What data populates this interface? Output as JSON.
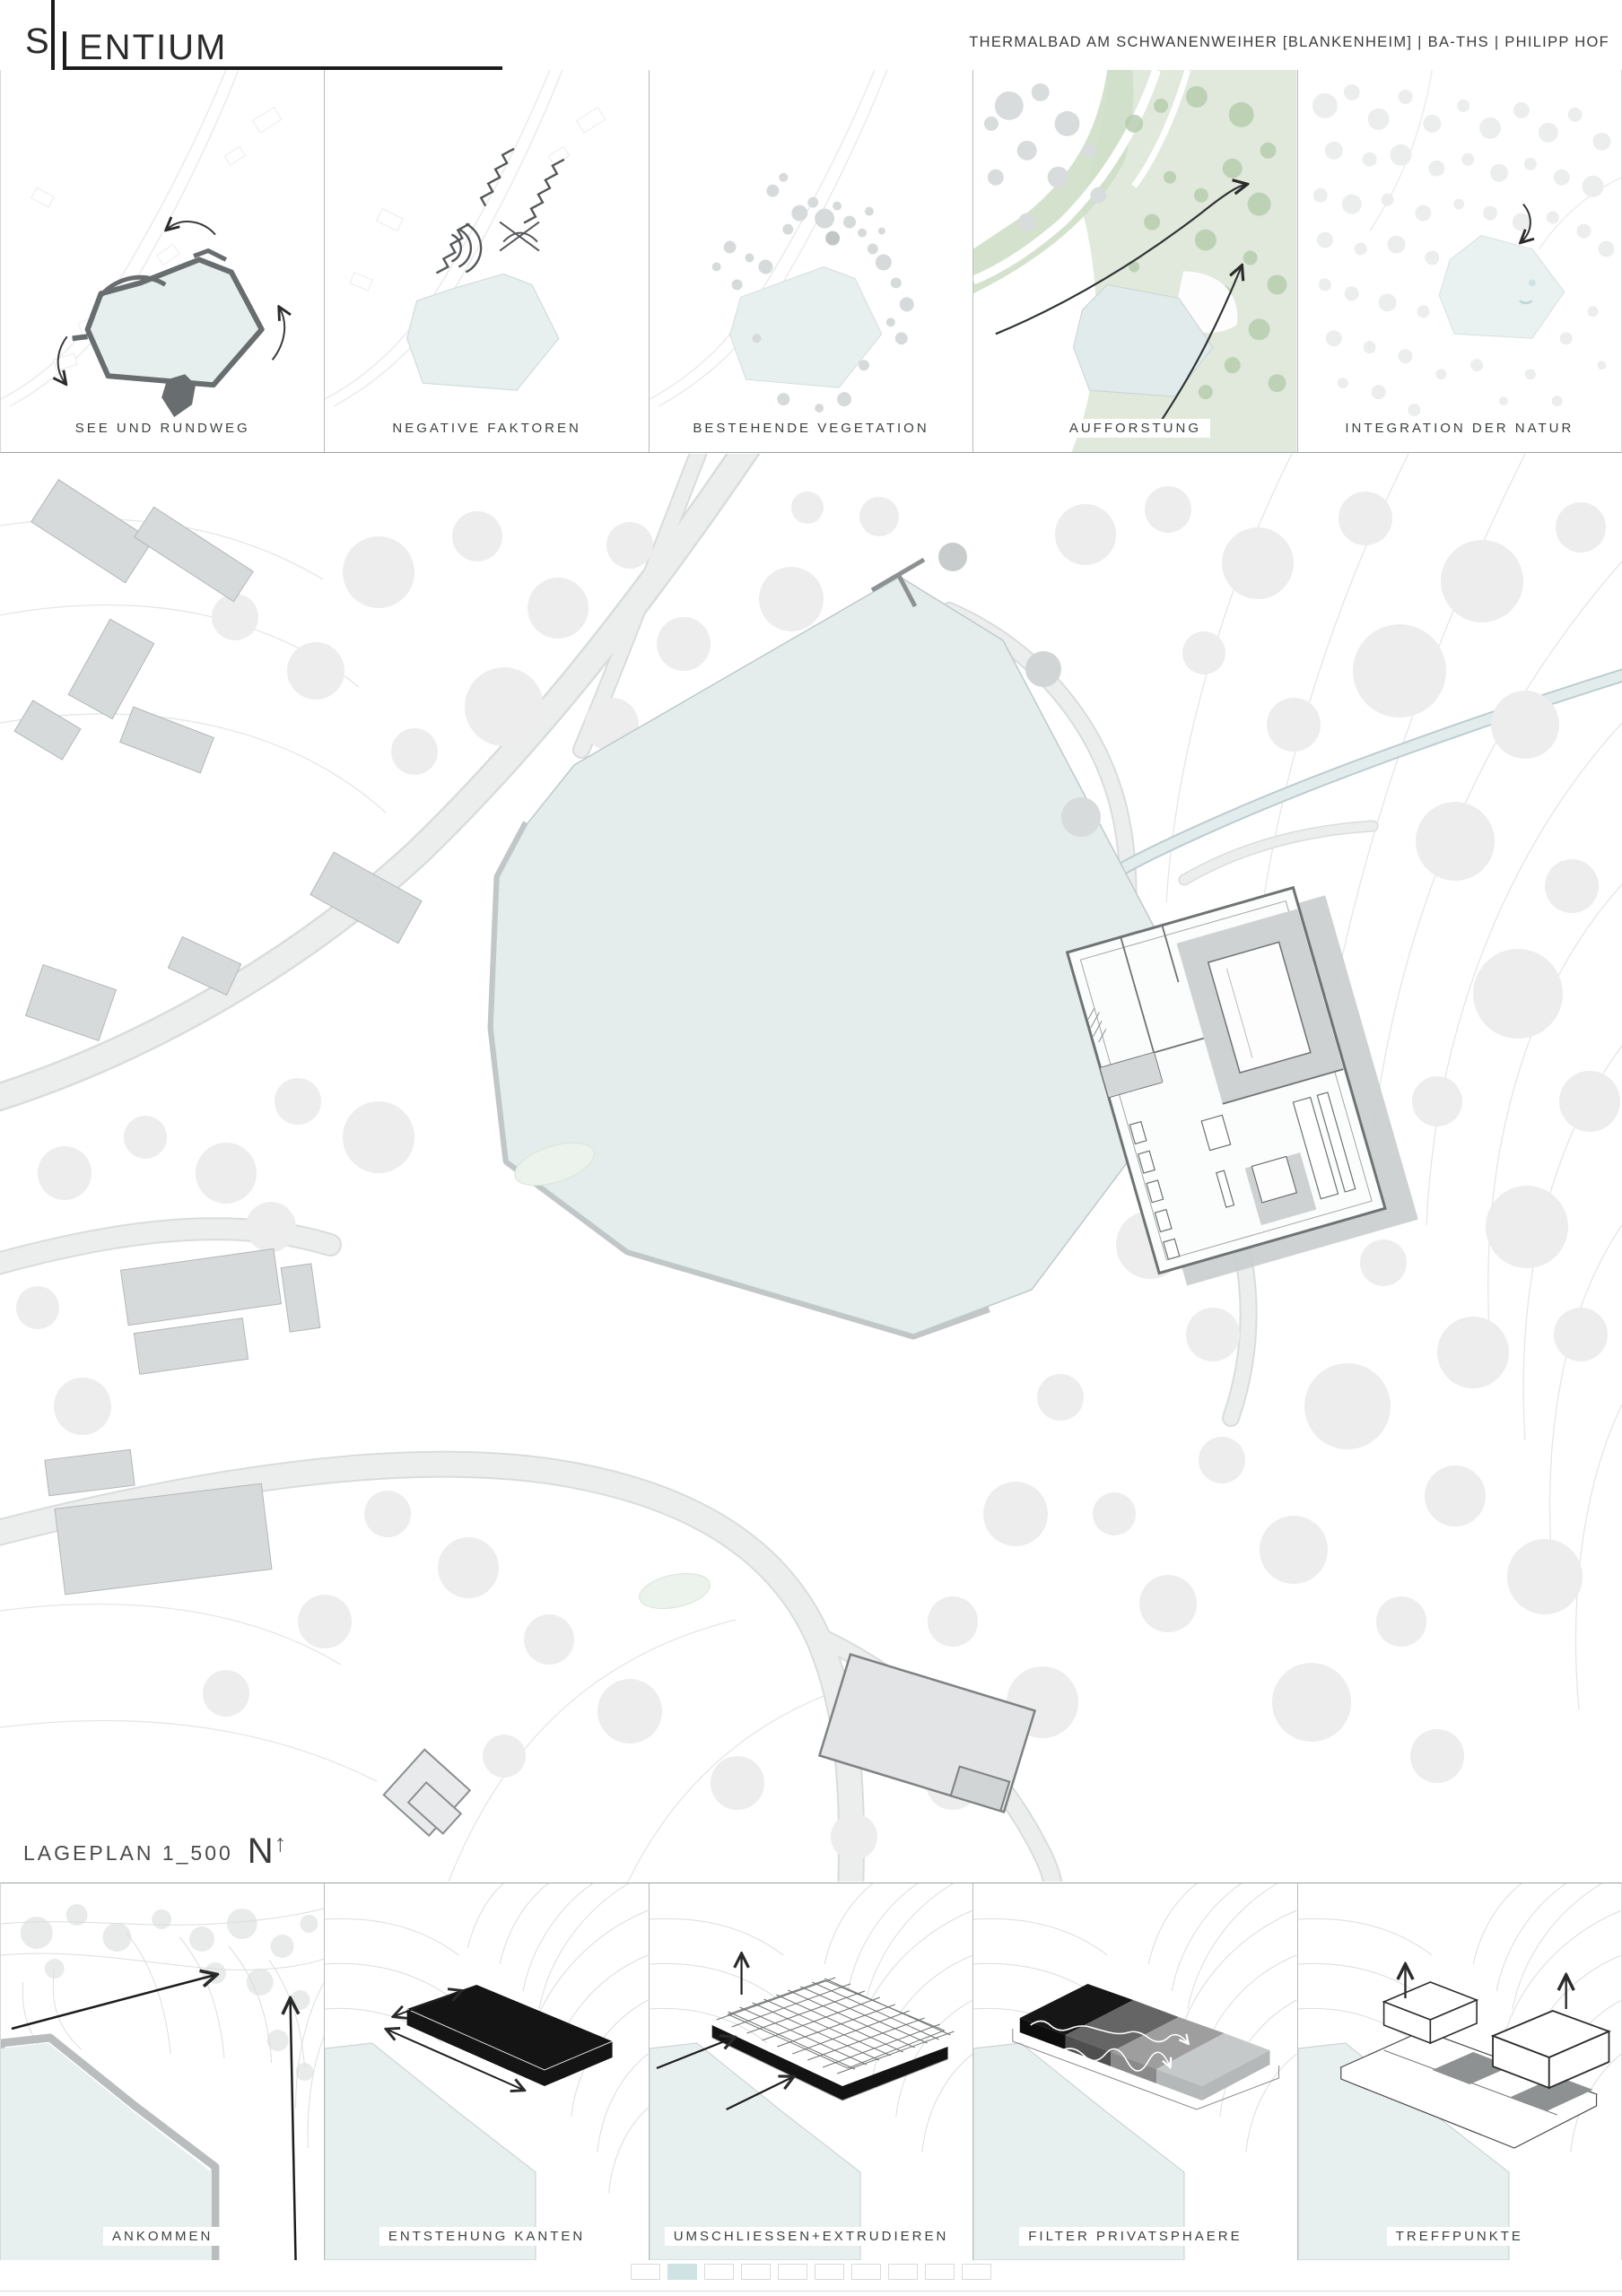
{
  "header": {
    "logo_s": "S",
    "logo_rest": "ENTIUM",
    "project_info": "THERMALBAD AM SCHWANENWEIHER [BLANKENHEIM] | BA-THS | PHILIPP HOF"
  },
  "top_diagrams": [
    {
      "label": "SEE UND RUNDWEG"
    },
    {
      "label": "NEGATIVE FAKTOREN"
    },
    {
      "label": "BESTEHENDE VEGETATION"
    },
    {
      "label": "AUFFORSTUNG"
    },
    {
      "label": "INTEGRATION DER NATUR"
    }
  ],
  "site_plan": {
    "caption": "LAGEPLAN 1_500",
    "north_label": "N",
    "north_arrow": "↑"
  },
  "bottom_diagrams": [
    {
      "label": "ANKOMMEN"
    },
    {
      "label": "ENTSTEHUNG KANTEN"
    },
    {
      "label": "UMSCHLIESSEN+EXTRUDIEREN"
    },
    {
      "label": "FILTER PRIVATSPHAERE"
    },
    {
      "label": "TREFFPUNKTE"
    }
  ],
  "pagination": {
    "total": 10,
    "active_index": 1,
    "active_color": "#cfe2e4"
  },
  "colors": {
    "ink": "#222222",
    "lake": "#e4ecec",
    "forest_green": "#e0e9db",
    "diagram_dark": "#686d6f",
    "page_active": "#cfe2e4"
  }
}
